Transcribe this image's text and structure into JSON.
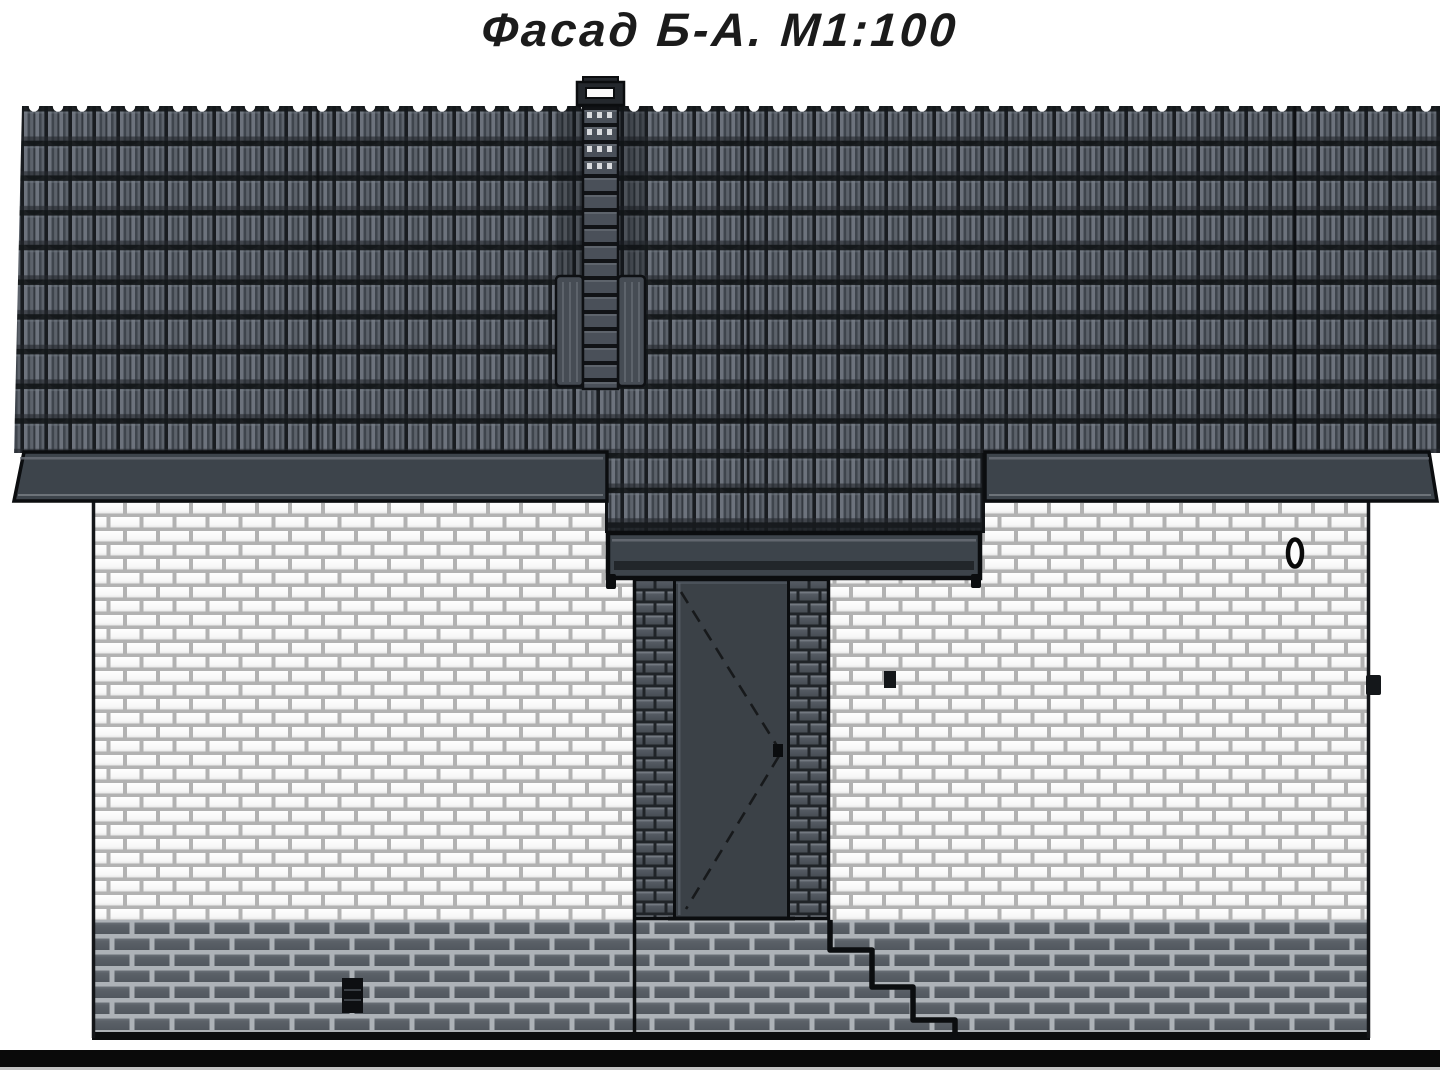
{
  "title": {
    "text": "Фасад Б-А. М1:100"
  },
  "drawing": {
    "kind": "house facade elevation",
    "facade_axes": "Б-А",
    "scale_label": "М1:100"
  },
  "palette": {
    "background": "#ffffff",
    "roof_tile_base": "#4b515a",
    "roof_tile_highlight": "#6d737d",
    "roof_tile_shadow": "#14171a",
    "fascia": "#3d444b",
    "fascia_dark_strip": "#22262a",
    "white_brick": "#fdfdfd",
    "white_brick_mortar": "#b2b2b2",
    "plinth_brick": "#596067",
    "plinth_mortar": "#adb2b7",
    "pier_brick": "#4e545c",
    "pier_mortar": "#202428",
    "door_leaf": "#3b4147",
    "outline": "#0b0d0f",
    "ground_line": "#0a0a0a",
    "title_color": "#1b1b1b"
  }
}
